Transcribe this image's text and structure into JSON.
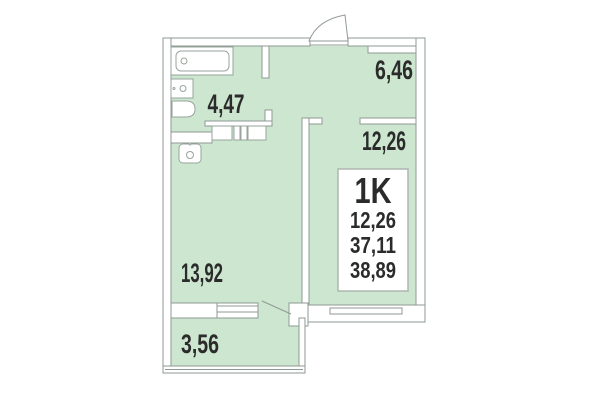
{
  "floor_plan": {
    "unit_label": "1K",
    "areas": {
      "hallway": "6,46",
      "bathroom": "4,47",
      "room": "12,26",
      "living_kitchen": "13,92",
      "balcony": "3,56"
    },
    "info_box": {
      "type": "1K",
      "values": [
        "12,26",
        "37,11",
        "38,89"
      ]
    },
    "colors": {
      "floor": "#cde6d0",
      "wall_line": "#8f9a94",
      "text": "#2b2b2b",
      "background": "#ffffff"
    }
  }
}
